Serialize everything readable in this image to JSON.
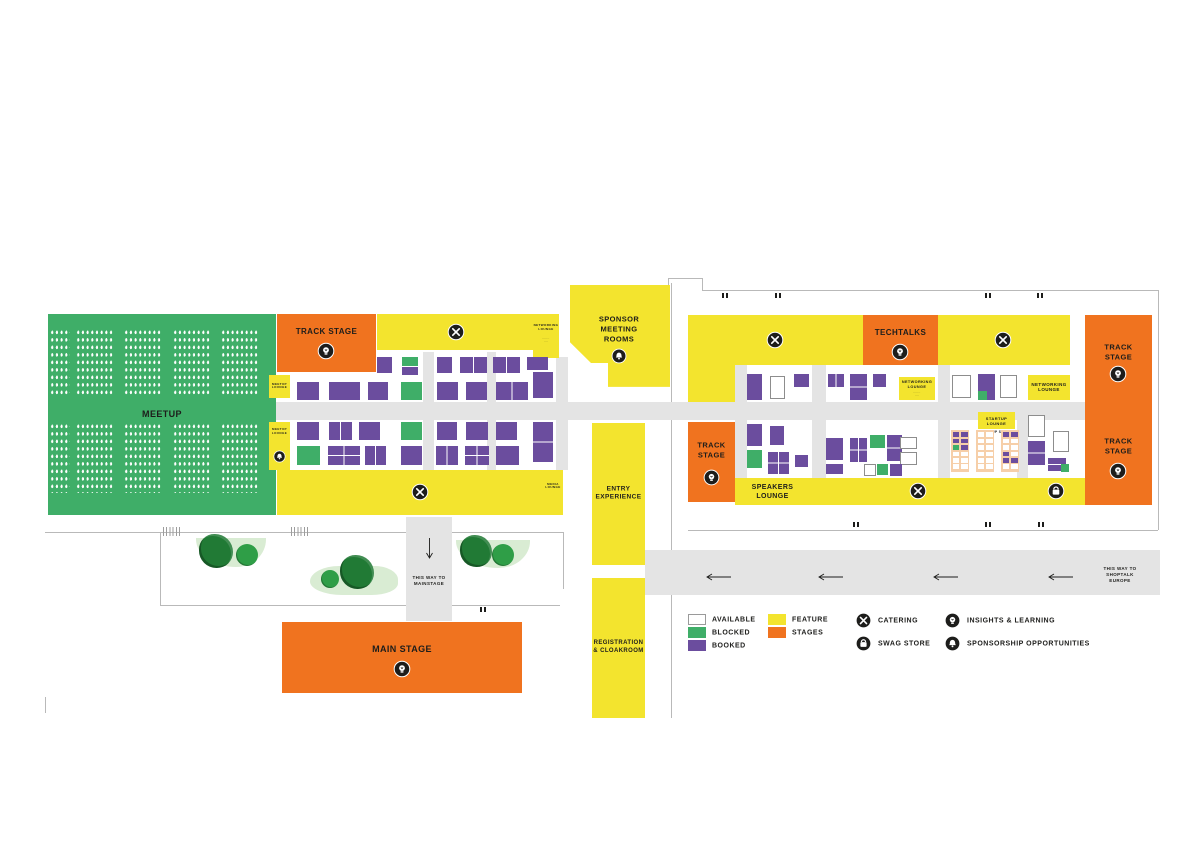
{
  "palette": {
    "available": "#ffffff",
    "blocked": "#3fae68",
    "booked": "#6b4d9e",
    "feature": "#f3e42e",
    "stages": "#f0731f",
    "corridor": "#e4e4e4",
    "wall": "#b9b9b9",
    "garden": "#d9ecd3",
    "tree": "#217a35",
    "tree_small": "#2f9e47",
    "studio": "#f6cfa9",
    "ink": "#1d1d1b",
    "booth_border": "#8d8d8d"
  },
  "legend": {
    "items": [
      {
        "type": "swatch",
        "label": "AVAILABLE",
        "color": "available",
        "x": 688,
        "y": 614
      },
      {
        "type": "swatch",
        "label": "BLOCKED",
        "color": "blocked",
        "x": 688,
        "y": 627
      },
      {
        "type": "swatch",
        "label": "BOOKED",
        "color": "booked",
        "x": 688,
        "y": 640
      },
      {
        "type": "swatch",
        "label": "FEATURE",
        "color": "feature",
        "x": 768,
        "y": 614
      },
      {
        "type": "swatch",
        "label": "STAGES",
        "color": "stages",
        "x": 768,
        "y": 627
      },
      {
        "type": "icon",
        "icon": "catering",
        "label": "CATERING",
        "x": 855,
        "y": 612
      },
      {
        "type": "icon",
        "icon": "swag",
        "label": "SWAG STORE",
        "x": 855,
        "y": 635
      },
      {
        "type": "icon",
        "icon": "insights",
        "label": "INSIGHTS & LEARNING",
        "x": 944,
        "y": 612
      },
      {
        "type": "icon",
        "icon": "sponsorship",
        "label": "SPONSORSHIP OPPORTUNITIES",
        "x": 944,
        "y": 635
      }
    ]
  },
  "zones": [
    {
      "id": "meetup-area",
      "x": 48,
      "y": 314,
      "w": 228,
      "h": 201,
      "color": "blocked",
      "label": "MEETUP",
      "fs": 9
    },
    {
      "id": "track-stage-west",
      "x": 277,
      "y": 314,
      "w": 99,
      "h": 58,
      "color": "stages",
      "label": "TRACK STAGE",
      "fs": 8,
      "lcy": 332,
      "icon": "insights",
      "ix": 326,
      "iy": 351,
      "ir": 9
    },
    {
      "id": "feature-top-west",
      "x": 377,
      "y": 314,
      "w": 156,
      "h": 36,
      "color": "feature",
      "icon": "catering",
      "ix": 456,
      "iy": 332,
      "ir": 9
    },
    {
      "id": "networking-lounge-west",
      "x": 533,
      "y": 314,
      "w": 26,
      "h": 44,
      "color": "feature",
      "label": "NETWORKING\nLOUNGE",
      "fs": 3,
      "lcy": 328,
      "sub": "·······\n····",
      "sfs": 2,
      "scy": 341
    },
    {
      "id": "meetup-lounge-a",
      "x": 269,
      "y": 375,
      "w": 21,
      "h": 23,
      "color": "feature",
      "label": "MEETUP\nLOUNGE",
      "fs": 3
    },
    {
      "id": "meetup-lounge-b",
      "x": 269,
      "y": 422,
      "w": 21,
      "h": 48,
      "color": "feature",
      "label": "MEETUP\nLOUNGE",
      "fs": 3,
      "lcy": 432,
      "icon": "sponsorship",
      "ix": 279,
      "iy": 456,
      "ir": 6.5
    },
    {
      "id": "feature-bottom-west",
      "x": 277,
      "y": 470,
      "w": 286,
      "h": 45,
      "color": "feature",
      "icon": "catering",
      "ix": 420,
      "iy": 492,
      "ir": 9
    },
    {
      "id": "media-lounge",
      "x": 543,
      "y": 470,
      "w": 20,
      "h": 33,
      "color": "feature",
      "label": "MEDIA\nLOUNGE",
      "fs": 3
    },
    {
      "id": "sponsor-meeting-rooms",
      "x": 570,
      "y": 285,
      "w": 100,
      "h": 104,
      "color": "feature",
      "clip": "polygon(0% 0%, 100% 0%, 100% 98%, 38% 98%, 38% 75%, 21% 75%, 0% 55%)",
      "label": "SPONSOR\nMEETING\nROOMS",
      "fs": 7.5,
      "lcx": 619,
      "lcy": 329,
      "icon": "sponsorship",
      "ix": 619,
      "iy": 356,
      "ir": 8
    },
    {
      "id": "entry-experience",
      "x": 592,
      "y": 423,
      "w": 53,
      "h": 142,
      "color": "feature",
      "label": "ENTRY\nEXPERIENCE",
      "fs": 6.5
    },
    {
      "id": "registration-cloakroom",
      "x": 592,
      "y": 578,
      "w": 53,
      "h": 140,
      "color": "feature",
      "label": "REGISTRATION\n& CLOAKROOM",
      "fs": 6
    },
    {
      "id": "main-stage",
      "x": 282,
      "y": 622,
      "w": 240,
      "h": 71,
      "color": "stages",
      "label": "MAIN STAGE",
      "fs": 9,
      "lcy": 650,
      "icon": "insights",
      "ix": 402,
      "iy": 669,
      "ir": 9
    },
    {
      "id": "feature-top-east-a",
      "x": 688,
      "y": 315,
      "w": 175,
      "h": 50,
      "color": "feature",
      "icon": "catering",
      "ix": 775,
      "iy": 340,
      "ir": 9
    },
    {
      "id": "techtalks",
      "x": 863,
      "y": 315,
      "w": 75,
      "h": 50,
      "color": "stages",
      "label": "TECHTALKS",
      "fs": 8,
      "lcy": 333,
      "icon": "insights",
      "ix": 900,
      "iy": 352,
      "ir": 9
    },
    {
      "id": "feature-top-east-b",
      "x": 938,
      "y": 315,
      "w": 132,
      "h": 50,
      "color": "feature",
      "icon": "catering",
      "ix": 1003,
      "iy": 340,
      "ir": 9
    },
    {
      "id": "feature-col-east",
      "x": 688,
      "y": 365,
      "w": 47,
      "h": 37,
      "color": "feature"
    },
    {
      "id": "track-stage-east-left",
      "x": 688,
      "y": 422,
      "w": 47,
      "h": 80,
      "color": "stages",
      "label": "TRACK\nSTAGE",
      "fs": 7.5,
      "lcy": 450,
      "icon": "insights",
      "ix": 711,
      "iy": 477,
      "ir": 8.5
    },
    {
      "id": "speakers-lounge",
      "x": 735,
      "y": 478,
      "w": 75,
      "h": 27,
      "color": "feature",
      "label": "SPEAKERS\nLOUNGE",
      "fs": 7
    },
    {
      "id": "feature-bottom-east-a",
      "x": 810,
      "y": 478,
      "w": 218,
      "h": 27,
      "color": "feature",
      "icon": "catering",
      "ix": 918,
      "iy": 491,
      "ir": 9
    },
    {
      "id": "feature-bottom-east-b",
      "x": 1028,
      "y": 478,
      "w": 57,
      "h": 27,
      "color": "feature",
      "icon": "swag",
      "ix": 1056,
      "iy": 491,
      "ir": 9
    },
    {
      "id": "track-stage-north-east",
      "x": 1085,
      "y": 315,
      "w": 67,
      "h": 92,
      "color": "stages",
      "label": "TRACK\nSTAGE",
      "fs": 7.5,
      "lcy": 352,
      "icon": "insights",
      "ix": 1118,
      "iy": 374,
      "ir": 9
    },
    {
      "id": "track-stage-south-east",
      "x": 1085,
      "y": 407,
      "w": 67,
      "h": 98,
      "color": "stages",
      "label": "TRACK\nSTAGE",
      "fs": 7.5,
      "lcy": 446,
      "icon": "insights",
      "ix": 1118,
      "iy": 471,
      "ir": 9
    },
    {
      "id": "networking-lounge-east",
      "x": 1028,
      "y": 375,
      "w": 42,
      "h": 25,
      "color": "feature",
      "label": "NETWORKING\nLOUNGE",
      "fs": 4.5
    },
    {
      "id": "networking-lounge-mid",
      "x": 899,
      "y": 377,
      "w": 36,
      "h": 23,
      "color": "feature",
      "label": "NETWORKING\nLOUNGE",
      "fs": 3.8,
      "lcy": 385,
      "sub": "·······\n····",
      "sfs": 2,
      "scy": 395
    },
    {
      "id": "startup-lounge",
      "x": 978,
      "y": 412,
      "w": 37,
      "h": 17,
      "color": "feature",
      "label": "STARTUP\nLOUNGE",
      "fs": 4
    },
    {
      "id": "startup-studio-caption",
      "x": 969,
      "y": 429,
      "w": 55,
      "h": 6,
      "color": "none",
      "label": "STARTUP STUDIO",
      "fs": 3.2
    },
    {
      "id": "mainstage-way-label",
      "x": 406,
      "y": 570,
      "w": 46,
      "h": 22,
      "color": "none",
      "label": "THIS WAY TO\nMAINSTAGE",
      "fs": 4.5
    },
    {
      "id": "shoptalk-way-label",
      "x": 1090,
      "y": 560,
      "w": 60,
      "h": 30,
      "color": "none",
      "label": "THIS WAY TO\nSHOPTALK\nEUROPE",
      "fs": 4.5
    }
  ],
  "seat_blocks": [
    {
      "x": 50,
      "y": 329,
      "w": 20,
      "h": 66
    },
    {
      "x": 76,
      "y": 329,
      "w": 38,
      "h": 66
    },
    {
      "x": 124,
      "y": 329,
      "w": 38,
      "h": 66
    },
    {
      "x": 173,
      "y": 329,
      "w": 38,
      "h": 66
    },
    {
      "x": 221,
      "y": 329,
      "w": 38,
      "h": 66
    },
    {
      "x": 50,
      "y": 423,
      "w": 20,
      "h": 70
    },
    {
      "x": 76,
      "y": 423,
      "w": 38,
      "h": 70
    },
    {
      "x": 124,
      "y": 423,
      "w": 38,
      "h": 70
    },
    {
      "x": 173,
      "y": 423,
      "w": 38,
      "h": 70
    },
    {
      "x": 221,
      "y": 423,
      "w": 38,
      "h": 70
    }
  ],
  "booths_left": [
    [
      377,
      357,
      15,
      16,
      "p"
    ],
    [
      402,
      357,
      16,
      9,
      "g"
    ],
    [
      402,
      367,
      16,
      8,
      "p"
    ],
    [
      437,
      357,
      15,
      16,
      "p"
    ],
    [
      460,
      357,
      27,
      16,
      "p",
      "v"
    ],
    [
      493,
      357,
      27,
      16,
      "p",
      "v"
    ],
    [
      527,
      357,
      21,
      13,
      "p"
    ],
    [
      533,
      372,
      20,
      26,
      "p"
    ],
    [
      297,
      382,
      22,
      18,
      "p"
    ],
    [
      329,
      382,
      31,
      18,
      "p"
    ],
    [
      368,
      382,
      20,
      18,
      "p"
    ],
    [
      401,
      382,
      21,
      18,
      "g"
    ],
    [
      437,
      382,
      21,
      18,
      "p"
    ],
    [
      466,
      382,
      21,
      18,
      "p"
    ],
    [
      496,
      382,
      32,
      18,
      "p",
      "v"
    ],
    [
      297,
      422,
      22,
      18,
      "p"
    ],
    [
      329,
      422,
      23,
      18,
      "p",
      "v"
    ],
    [
      359,
      422,
      21,
      18,
      "p"
    ],
    [
      401,
      422,
      21,
      18,
      "g"
    ],
    [
      437,
      422,
      20,
      18,
      "p"
    ],
    [
      466,
      422,
      22,
      18,
      "p"
    ],
    [
      496,
      422,
      21,
      18,
      "p"
    ],
    [
      533,
      422,
      20,
      40,
      "p",
      "h"
    ],
    [
      297,
      446,
      23,
      19,
      "g"
    ],
    [
      328,
      446,
      32,
      19,
      "p",
      "grid"
    ],
    [
      365,
      446,
      21,
      19,
      "p",
      "v"
    ],
    [
      401,
      446,
      21,
      19,
      "p"
    ],
    [
      436,
      446,
      22,
      19,
      "p",
      "v"
    ],
    [
      465,
      446,
      24,
      19,
      "p",
      "grid"
    ],
    [
      496,
      446,
      23,
      19,
      "p"
    ]
  ],
  "booths_right": [
    [
      747,
      374,
      15,
      26,
      "p"
    ],
    [
      770,
      376,
      15,
      23,
      "w"
    ],
    [
      794,
      374,
      15,
      13,
      "p"
    ],
    [
      828,
      374,
      16,
      13,
      "p",
      "v"
    ],
    [
      850,
      374,
      17,
      26,
      "p",
      "h"
    ],
    [
      873,
      374,
      13,
      13,
      "p"
    ],
    [
      952,
      375,
      19,
      23,
      "w"
    ],
    [
      978,
      374,
      17,
      26,
      "p"
    ],
    [
      978,
      391,
      9,
      9,
      "g"
    ],
    [
      1000,
      375,
      17,
      23,
      "w"
    ],
    [
      747,
      424,
      15,
      22,
      "p"
    ],
    [
      770,
      426,
      14,
      19,
      "p"
    ],
    [
      826,
      438,
      17,
      22,
      "p"
    ],
    [
      850,
      438,
      17,
      24,
      "p",
      "grid"
    ],
    [
      870,
      435,
      15,
      13,
      "g"
    ],
    [
      887,
      435,
      15,
      26,
      "p",
      "h"
    ],
    [
      900,
      437,
      17,
      12,
      "w"
    ],
    [
      900,
      452,
      17,
      13,
      "w"
    ],
    [
      747,
      450,
      15,
      18,
      "g"
    ],
    [
      768,
      452,
      21,
      22,
      "p",
      "grid"
    ],
    [
      795,
      455,
      13,
      12,
      "p"
    ],
    [
      826,
      464,
      17,
      10,
      "p"
    ],
    [
      864,
      464,
      12,
      12,
      "w"
    ],
    [
      877,
      464,
      11,
      11,
      "g"
    ],
    [
      890,
      464,
      12,
      12,
      "p"
    ],
    [
      1028,
      415,
      17,
      22,
      "w"
    ],
    [
      1053,
      431,
      16,
      21,
      "w"
    ],
    [
      1028,
      441,
      17,
      24,
      "p",
      "h"
    ],
    [
      1048,
      458,
      18,
      13,
      "p",
      "h"
    ],
    [
      1061,
      464,
      8,
      8,
      "g"
    ]
  ],
  "studio_strips": [
    {
      "x": 951,
      "y": 430,
      "w": 18,
      "h": 42,
      "cells": [
        [
          "p",
          "p"
        ],
        [
          "p",
          "p"
        ],
        [
          "g",
          "p"
        ],
        [
          "w",
          "w"
        ],
        [
          "w",
          "w"
        ],
        [
          "w",
          "w"
        ]
      ]
    },
    {
      "x": 976,
      "y": 430,
      "w": 18,
      "h": 42,
      "cells": [
        [
          "w",
          "w"
        ],
        [
          "w",
          "w"
        ],
        [
          "w",
          "w"
        ],
        [
          "w",
          "w"
        ],
        [
          "w",
          "w"
        ],
        [
          "w",
          "w"
        ]
      ]
    },
    {
      "x": 1001,
      "y": 430,
      "w": 18,
      "h": 42,
      "cells": [
        [
          "p",
          "p"
        ],
        [
          "w",
          "w"
        ],
        [
          "w",
          "w"
        ],
        [
          "p",
          "w"
        ],
        [
          "p",
          "p"
        ],
        [
          "w",
          "w"
        ]
      ]
    }
  ],
  "corridors": [
    [
      276,
      402,
      809,
      18
    ],
    [
      423,
      352,
      11,
      118
    ],
    [
      487,
      352,
      9,
      118
    ],
    [
      556,
      357,
      12,
      113
    ],
    [
      406,
      517,
      46,
      104
    ],
    [
      645,
      550,
      515,
      45
    ],
    [
      735,
      365,
      12,
      113
    ],
    [
      812,
      365,
      14,
      113
    ],
    [
      938,
      365,
      12,
      113
    ],
    [
      1017,
      407,
      11,
      71
    ]
  ],
  "walls": [
    [
      668,
      278,
      34,
      1
    ],
    [
      668,
      278,
      1,
      8
    ],
    [
      702,
      278,
      1,
      12
    ],
    [
      702,
      290,
      456,
      1
    ],
    [
      1158,
      290,
      1,
      240
    ],
    [
      688,
      530,
      470,
      1
    ],
    [
      45,
      532,
      361,
      1
    ],
    [
      452,
      532,
      112,
      1
    ],
    [
      160,
      605,
      246,
      1
    ],
    [
      452,
      605,
      108,
      1
    ],
    [
      160,
      532,
      1,
      73
    ],
    [
      563,
      532,
      1,
      57
    ],
    [
      671,
      283,
      1,
      267
    ],
    [
      671,
      595,
      1,
      123
    ],
    [
      45,
      697,
      1,
      16
    ]
  ],
  "hatches": [
    [
      163,
      527
    ],
    [
      291,
      527
    ],
    [
      419,
      527
    ]
  ],
  "gardens": [
    {
      "x": 196,
      "y": 538,
      "w": 70,
      "h": 29,
      "kind": "ga"
    },
    {
      "x": 310,
      "y": 566,
      "w": 88,
      "h": 29,
      "kind": "gb"
    },
    {
      "x": 456,
      "y": 540,
      "w": 74,
      "h": 28,
      "kind": "ga"
    }
  ],
  "trees": [
    {
      "x": 216,
      "y": 551,
      "r": 17,
      "big": true
    },
    {
      "x": 247,
      "y": 555,
      "r": 11,
      "big": false
    },
    {
      "x": 330,
      "y": 579,
      "r": 9,
      "big": false
    },
    {
      "x": 357,
      "y": 572,
      "r": 17,
      "big": true
    },
    {
      "x": 476,
      "y": 551,
      "r": 16,
      "big": true
    },
    {
      "x": 503,
      "y": 555,
      "r": 11,
      "big": false
    }
  ],
  "door_marks": [
    [
      722,
      293
    ],
    [
      775,
      293
    ],
    [
      985,
      293
    ],
    [
      1037,
      293
    ],
    [
      853,
      522
    ],
    [
      985,
      522
    ],
    [
      1038,
      522
    ],
    [
      480,
      607
    ]
  ],
  "arrows": {
    "shoptalk": [
      [
        705,
        572
      ],
      [
        817,
        572
      ],
      [
        932,
        572
      ],
      [
        1047,
        572
      ]
    ],
    "mainstage": {
      "x": 426,
      "y": 538
    }
  }
}
